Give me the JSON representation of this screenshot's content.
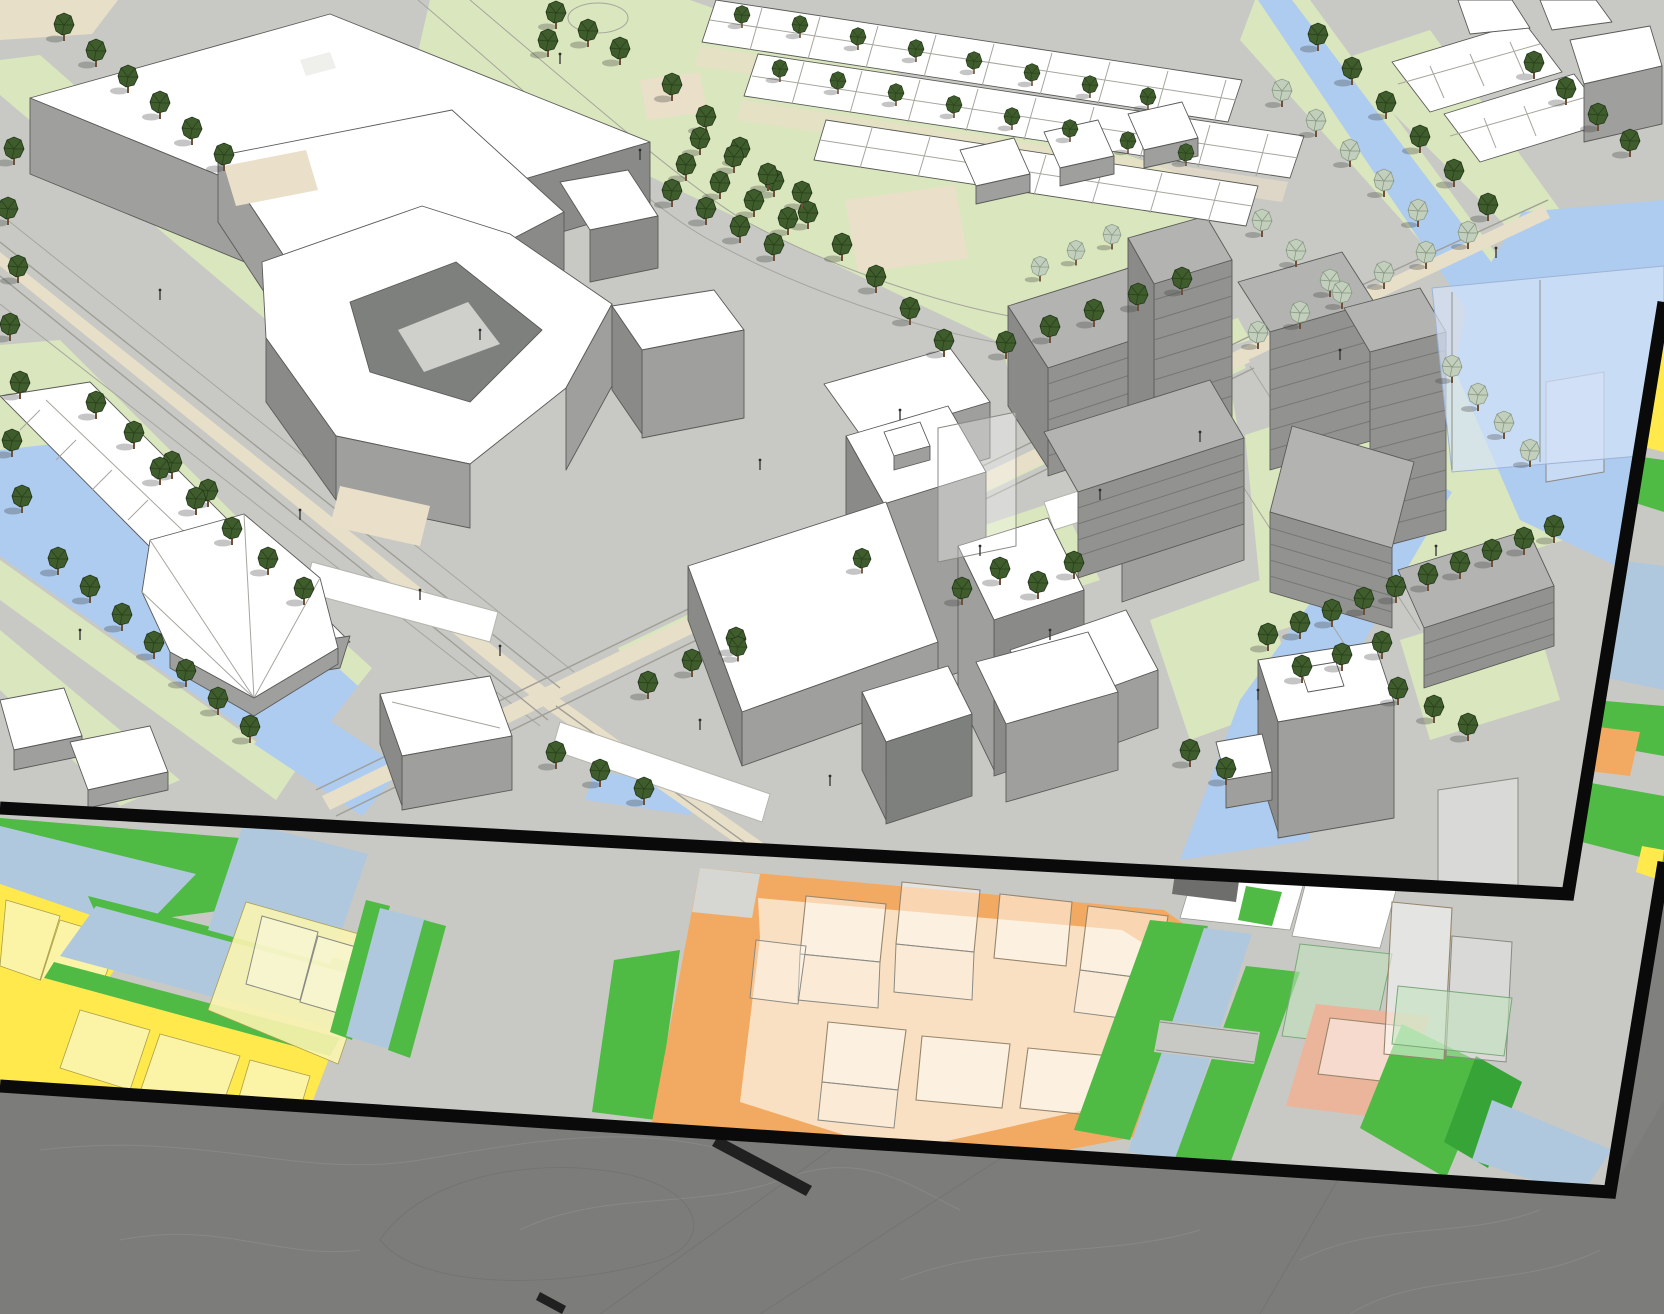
{
  "viewport": {
    "width": 1664,
    "height": 1314,
    "kind": "3d-axonometric-urban-model-over-zoning-plan"
  },
  "palette": {
    "road": "#C8C9C4",
    "grass": "#DAE6BD",
    "water_model": "#AECBF0",
    "water_overlay": "#D4E2F7",
    "sand": "#EADFC9",
    "median": "#E8DFC9",
    "bldg_white": "#FFFFFF",
    "bldg_side": "#9FA09E",
    "bldg_side_dark": "#8A8B88",
    "bldg_court": "#7E807E",
    "gray_roof": "#B3B4B1",
    "gray_side": "#929390",
    "gray_stripe": "#767773",
    "outline": "#5A5B58",
    "tree": "#3F5D2C",
    "tree_line": "#22351A",
    "tree_pale": "#C2CFBC",
    "tree_pale_line": "#8C9C88",
    "trunk": "#6E5138",
    "green_map": "#4FBA44",
    "yellow_map": "#FFE94C",
    "yellow_pale": "#FBF4B0",
    "water_map": "#AFC8DD",
    "orange_map": "#F2AA62",
    "orange_pale": "#F9E0C2",
    "salmon_map": "#EBB59B",
    "ghost_fill": "#FFFFFF",
    "ghost_stroke": "#97866C",
    "boundary": "#0A0A0A",
    "terrain": "#7C7D7B",
    "terrain_line": "#909190"
  },
  "layers": [
    {
      "id": "terrain-context",
      "label": "surrounding terrain mesh"
    },
    {
      "id": "zoning-map-band",
      "label": "flat zoning plan with coloured parcels"
    },
    {
      "id": "massing-model",
      "label": "3D urban massing model"
    }
  ],
  "zones": [
    {
      "name": "parcel-yellow",
      "palette": "yellow_map"
    },
    {
      "name": "planned-volume-pale-yellow",
      "palette": "yellow_pale"
    },
    {
      "name": "development-site-orange",
      "palette": "orange_map"
    },
    {
      "name": "public-green",
      "palette": "green_map"
    },
    {
      "name": "water",
      "palette": "water_map"
    },
    {
      "name": "parcel-salmon",
      "palette": "salmon_map"
    },
    {
      "name": "parcel-white",
      "palette": "bldg_white"
    },
    {
      "name": "planned-volume-ghost",
      "palette": "ghost_fill"
    }
  ],
  "model_elements": [
    {
      "name": "office-complex-northwest"
    },
    {
      "name": "courtyard-block"
    },
    {
      "name": "hospital-cluster-center"
    },
    {
      "name": "apartment-blocks-grey"
    },
    {
      "name": "tower-east"
    },
    {
      "name": "rowhouses-north"
    },
    {
      "name": "rowhouses-west"
    },
    {
      "name": "faceted-building-west"
    },
    {
      "name": "tram-boulevard"
    },
    {
      "name": "canal-west"
    },
    {
      "name": "canal-east"
    },
    {
      "name": "lake-northeast"
    },
    {
      "name": "park-north"
    }
  ],
  "trees": {
    "dark": [
      [
        14,
        150
      ],
      [
        8,
        210
      ],
      [
        18,
        268
      ],
      [
        10,
        326
      ],
      [
        20,
        384
      ],
      [
        12,
        442
      ],
      [
        22,
        498
      ],
      [
        64,
        26
      ],
      [
        96,
        52
      ],
      [
        128,
        78
      ],
      [
        160,
        104
      ],
      [
        192,
        130
      ],
      [
        224,
        156
      ],
      [
        672,
        86
      ],
      [
        706,
        118
      ],
      [
        740,
        150
      ],
      [
        774,
        182
      ],
      [
        808,
        214
      ],
      [
        842,
        246
      ],
      [
        876,
        278
      ],
      [
        910,
        310
      ],
      [
        944,
        342
      ],
      [
        700,
        140
      ],
      [
        734,
        158
      ],
      [
        768,
        176
      ],
      [
        802,
        194
      ],
      [
        686,
        166
      ],
      [
        720,
        184
      ],
      [
        754,
        202
      ],
      [
        788,
        220
      ],
      [
        672,
        192
      ],
      [
        706,
        210
      ],
      [
        740,
        228
      ],
      [
        774,
        246
      ],
      [
        556,
        14
      ],
      [
        588,
        32
      ],
      [
        620,
        50
      ],
      [
        548,
        42
      ],
      [
        1006,
        344
      ],
      [
        1050,
        328
      ],
      [
        1094,
        312
      ],
      [
        1138,
        296
      ],
      [
        1182,
        280
      ],
      [
        742,
        16,
        0.8
      ],
      [
        800,
        26,
        0.8
      ],
      [
        858,
        38,
        0.8
      ],
      [
        916,
        50,
        0.8
      ],
      [
        974,
        62,
        0.8
      ],
      [
        1032,
        74,
        0.8
      ],
      [
        1090,
        86,
        0.8
      ],
      [
        1148,
        98,
        0.8
      ],
      [
        780,
        70,
        0.8
      ],
      [
        838,
        82,
        0.8
      ],
      [
        896,
        94,
        0.8
      ],
      [
        954,
        106,
        0.8
      ],
      [
        1012,
        118,
        0.8
      ],
      [
        1070,
        130,
        0.8
      ],
      [
        1128,
        142,
        0.8
      ],
      [
        1186,
        154,
        0.8
      ],
      [
        96,
        404
      ],
      [
        134,
        434
      ],
      [
        172,
        464
      ],
      [
        208,
        492
      ],
      [
        58,
        560
      ],
      [
        90,
        588
      ],
      [
        122,
        616
      ],
      [
        154,
        644
      ],
      [
        186,
        672
      ],
      [
        218,
        700
      ],
      [
        250,
        728
      ],
      [
        160,
        470
      ],
      [
        196,
        500
      ],
      [
        232,
        530
      ],
      [
        268,
        560
      ],
      [
        304,
        590
      ],
      [
        648,
        684
      ],
      [
        692,
        662
      ],
      [
        736,
        640
      ],
      [
        962,
        590
      ],
      [
        1000,
        570
      ],
      [
        1038,
        584
      ],
      [
        1074,
        564
      ],
      [
        556,
        754
      ],
      [
        600,
        772
      ],
      [
        644,
        790
      ],
      [
        1268,
        636
      ],
      [
        1300,
        624
      ],
      [
        1332,
        612
      ],
      [
        1364,
        600
      ],
      [
        1396,
        588
      ],
      [
        1428,
        576
      ],
      [
        1460,
        564
      ],
      [
        1492,
        552
      ],
      [
        1524,
        540
      ],
      [
        1554,
        528
      ],
      [
        1302,
        668
      ],
      [
        1342,
        656
      ],
      [
        1382,
        644
      ],
      [
        1398,
        690
      ],
      [
        1434,
        708
      ],
      [
        1468,
        726
      ],
      [
        1190,
        752
      ],
      [
        1226,
        770
      ],
      [
        1318,
        36
      ],
      [
        1352,
        70
      ],
      [
        1386,
        104
      ],
      [
        1420,
        138
      ],
      [
        1454,
        172
      ],
      [
        1488,
        206
      ],
      [
        1534,
        64
      ],
      [
        1566,
        90
      ],
      [
        1598,
        116
      ],
      [
        1630,
        142
      ],
      [
        862,
        560,
        0.9
      ],
      [
        738,
        648,
        0.9
      ]
    ],
    "pale": [
      [
        1282,
        92
      ],
      [
        1316,
        122
      ],
      [
        1350,
        152
      ],
      [
        1384,
        182
      ],
      [
        1418,
        212
      ],
      [
        1262,
        222
      ],
      [
        1296,
        252
      ],
      [
        1330,
        282
      ],
      [
        1040,
        268,
        0.9
      ],
      [
        1076,
        252,
        0.9
      ],
      [
        1112,
        236,
        0.9
      ],
      [
        1452,
        368
      ],
      [
        1478,
        396
      ],
      [
        1504,
        424
      ],
      [
        1530,
        452
      ],
      [
        1258,
        334
      ],
      [
        1300,
        314
      ],
      [
        1342,
        294
      ],
      [
        1384,
        274
      ],
      [
        1426,
        254
      ],
      [
        1468,
        234
      ]
    ]
  },
  "lamps": [
    [
      300,
      520
    ],
    [
      420,
      600
    ],
    [
      500,
      656
    ],
    [
      700,
      730
    ],
    [
      830,
      786
    ],
    [
      980,
      556
    ],
    [
      1100,
      500
    ],
    [
      1200,
      442
    ],
    [
      640,
      160
    ],
    [
      480,
      340
    ],
    [
      1340,
      360
    ],
    [
      1436,
      556
    ],
    [
      1258,
      700
    ],
    [
      160,
      300
    ],
    [
      80,
      640
    ],
    [
      560,
      64
    ],
    [
      1496,
      258
    ],
    [
      900,
      420
    ],
    [
      1050,
      640
    ],
    [
      760,
      470
    ]
  ]
}
